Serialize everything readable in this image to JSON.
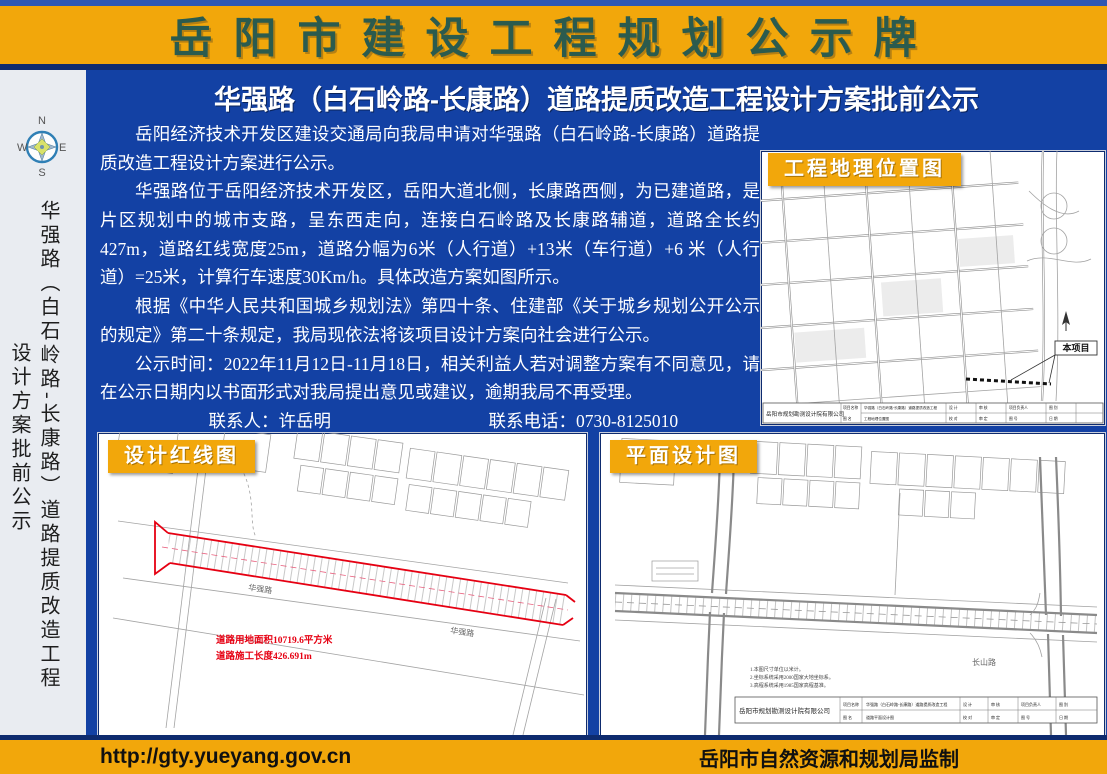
{
  "banner": {
    "title": "岳阳市建设工程规划公示牌"
  },
  "sidebar": {
    "compass": {
      "n": "N",
      "e": "E",
      "s": "S",
      "w": "W"
    },
    "vertical_title": "华强路（白石岭路-长康路）道路提质改造工程",
    "vertical_subtitle": "设计方案批前公示"
  },
  "notice": {
    "title": "华强路（白石岭路-长康路）道路提质改造工程设计方案批前公示",
    "paragraphs": [
      "岳阳经济技术开发区建设交通局向我局申请对华强路（白石岭路-长康路）道路提质改造工程设计方案进行公示。",
      "华强路位于岳阳经济技术开发区，岳阳大道北侧，长康路西侧，为已建道路，是片区规划中的城市支路，呈东西走向，连接白石岭路及长康路辅道，道路全长约427m，道路红线宽度25m，道路分幅为6米（人行道）+13米（车行道）+6 米（人行道）=25米，计算行车速度30Km/h。具体改造方案如图所示。",
      "根据《中华人民共和国城乡规划法》第四十条、住建部《关于城乡规划公开公示的规定》第二十条规定，我局现依法将该项目设计方案向社会进行公示。",
      "公示时间：2022年11月12日-11月18日，相关利益人若对调整方案有不同意见，请在公示日期内以书面形式对我局提出意见或建议，逾期我局不再受理。"
    ],
    "contact_person": "联系人：许岳明",
    "contact_phone": "联系电话：0730-8125010"
  },
  "maps": {
    "titleblock": {
      "company": "岳阳市规划勘测设计院有限公司",
      "project_label": "项目名称",
      "drawing_label": "图 名",
      "project_name": "华强路（白石岭路-长康路）道路提质改造工程",
      "cells": {
        "design": "设 计",
        "check": "校 对",
        "review": "审 核",
        "approve": "审 定",
        "lead": "项目负责人",
        "no": "图 号",
        "type": "图 别",
        "date": "日 期"
      }
    },
    "location": {
      "label": "工程地理位置图",
      "drawing_name": "工程地理位置图",
      "project_callout": "本项目"
    },
    "redline": {
      "label": "设计红线图",
      "area_note": "道路用地面积10719.6平方米",
      "length_note": "道路施工长度426.691m",
      "road_name": "华强路"
    },
    "plan": {
      "label": "平面设计图",
      "drawing_name": "道路平面设计图",
      "road_label": "长山路",
      "notes": [
        "1.本图尺寸单位以米计。",
        "2.坐标系统采用2000国家大地坐标系。",
        "3.高程系统采用1985国家高程基准。"
      ]
    }
  },
  "footer": {
    "url": "http://gty.yueyang.gov.cn",
    "credit": "岳阳市自然资源和规划局监制"
  },
  "colors": {
    "banner_bg": "#F2A70B",
    "banner_text": "#2B5B4E",
    "panel_blue": "#1341A4",
    "frame_blue": "#19388A",
    "redline_red": "#E60012"
  }
}
